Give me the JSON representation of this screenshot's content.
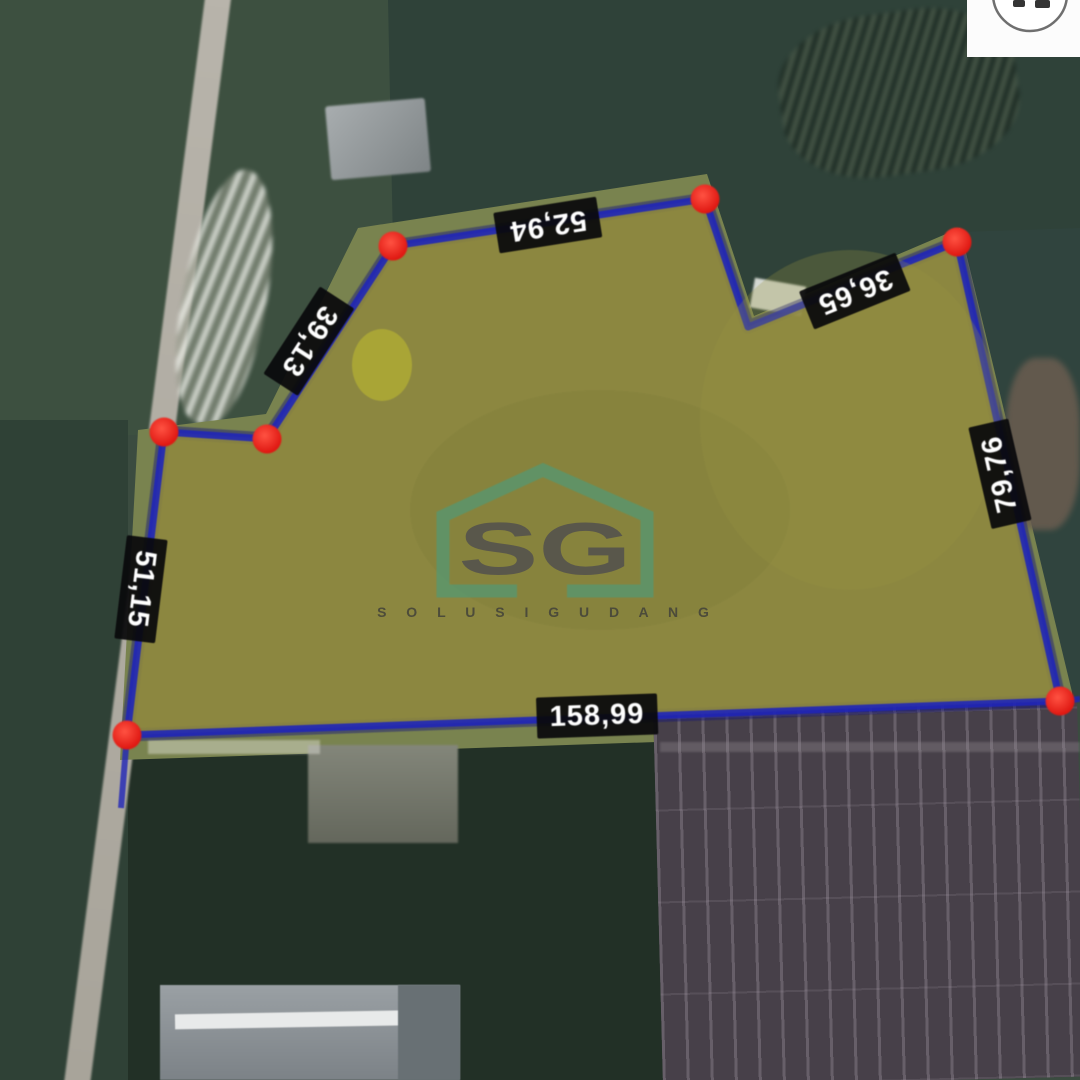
{
  "map": {
    "description": "aerial satellite view of a measured land plot",
    "vertex_marker": "red-dot",
    "vertex_count": 7,
    "measurements": [
      {
        "edge": "top",
        "value": "52,94"
      },
      {
        "edge": "top-right",
        "value": "36,65"
      },
      {
        "edge": "upper-left-diagonal",
        "value": "39,13"
      },
      {
        "edge": "left",
        "value": "51,15"
      },
      {
        "edge": "right",
        "value": "79,76"
      },
      {
        "edge": "bottom",
        "value": "158,99"
      }
    ]
  },
  "watermark": {
    "monogram": "SG",
    "wordmark": "S O L U S I  G U D A N G"
  },
  "colors": {
    "outline_blue": "#2026b8",
    "outline_glow": "#14147a",
    "plot_fill": "#8e883f",
    "vertex_red": "#e01812",
    "watermark_teal": "#3aa18c",
    "label_bg": "#09090b",
    "label_text": "#ffffff"
  }
}
